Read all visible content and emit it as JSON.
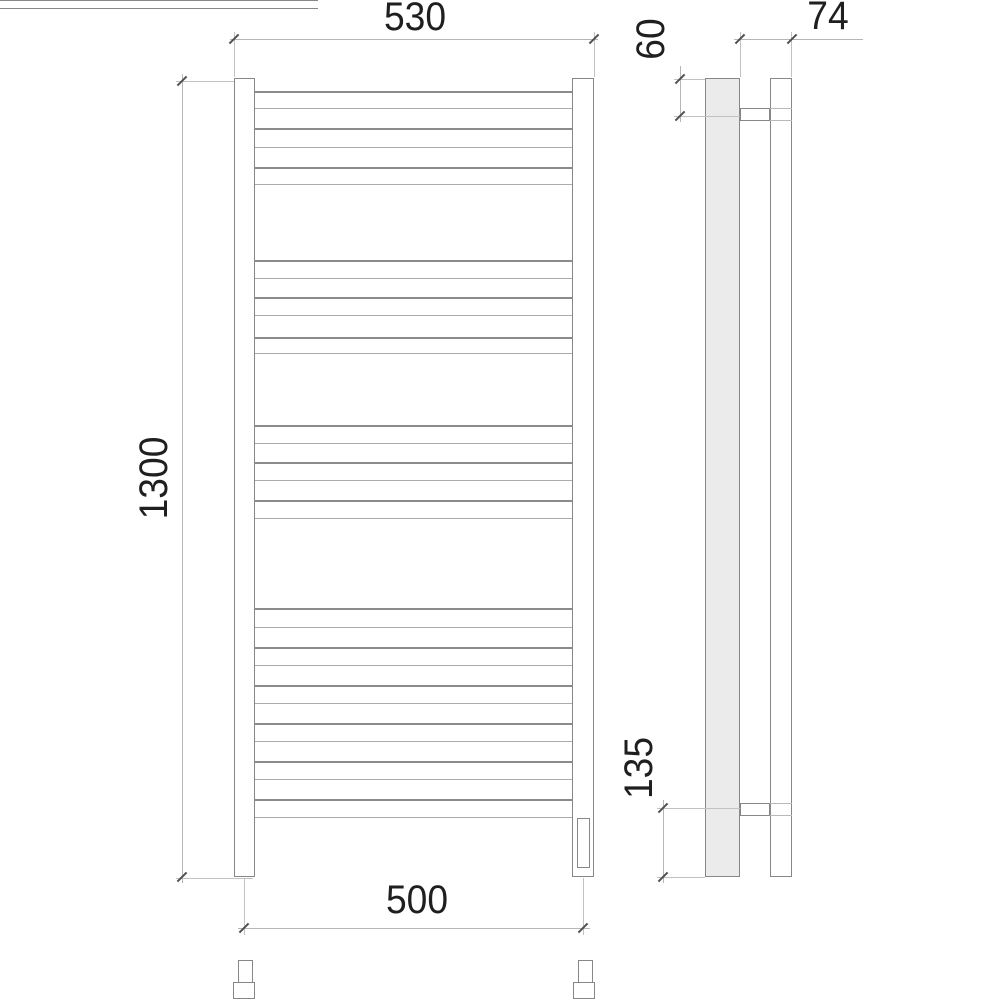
{
  "sheet": {
    "background": "#ffffff",
    "geometry_line_color": "#878787",
    "dimension_line_color": "#b6b6b6",
    "tick_color": "#4f4f4f",
    "text_color": "#1f1f1f",
    "profile_fill_color": "#ebebeb"
  },
  "dimensions": {
    "top_width": "530",
    "height": "1300",
    "bottom_width": "500",
    "depth": "74",
    "top_bracket_offset": "60",
    "bottom_bracket_offset": "135"
  },
  "front_view": {
    "rung_span": {
      "left": 255,
      "width": 317
    },
    "rung_groups": [
      [
        91,
        108,
        128,
        147,
        167,
        184
      ],
      [
        260,
        278,
        297,
        315,
        337,
        353
      ],
      [
        425,
        443,
        462,
        480,
        500,
        518
      ],
      [
        608,
        627,
        647,
        665,
        685,
        703,
        723,
        741,
        761,
        779,
        799,
        817
      ]
    ]
  }
}
